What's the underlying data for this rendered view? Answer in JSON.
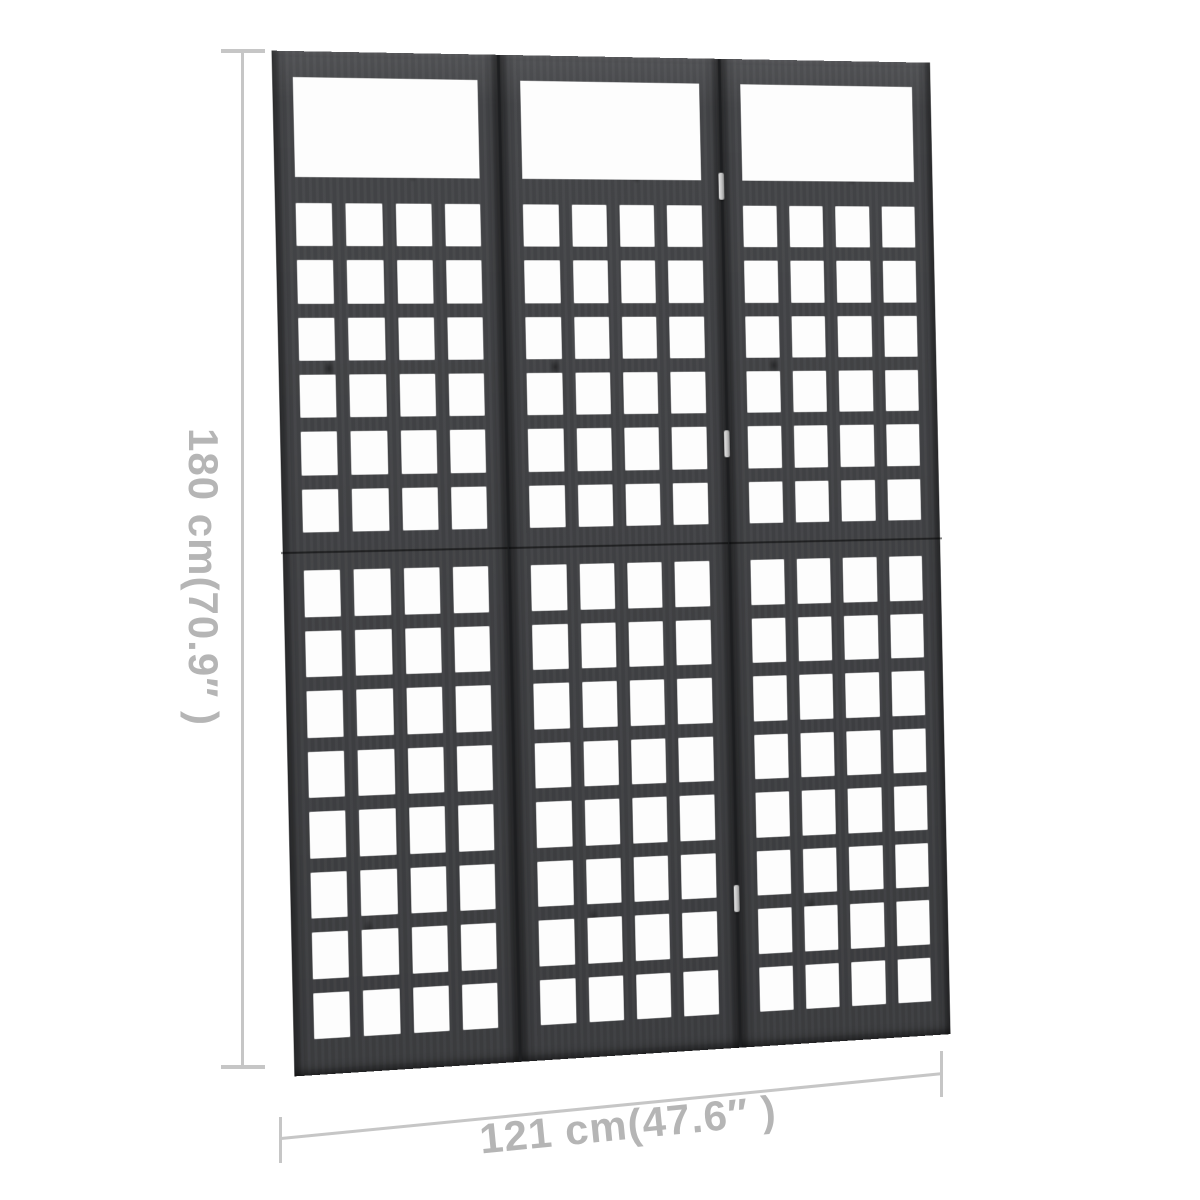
{
  "page": {
    "background_color": "#ffffff"
  },
  "divider": {
    "type": "room-divider-trellis",
    "finish": "black wood",
    "panel_count": 3,
    "lattice_columns": 4,
    "upper_lattice_rows": 6,
    "lower_lattice_rows": 8,
    "wood_color": "#46474a",
    "seam_color": "#1d1e20",
    "hinge_color": "#c2c2c2",
    "hinges": [
      {
        "x_percent": 66.666,
        "y_percent": 11.5
      },
      {
        "x_percent": 66.666,
        "y_percent": 37.5
      },
      {
        "x_percent": 66.666,
        "y_percent": 83.5
      }
    ]
  },
  "annotations": {
    "height_label": "180 cm(70.9″ )",
    "width_label": "121 cm(47.6″ )",
    "line_color": "#c6c6c6",
    "label_color": "#b5b5b5"
  }
}
